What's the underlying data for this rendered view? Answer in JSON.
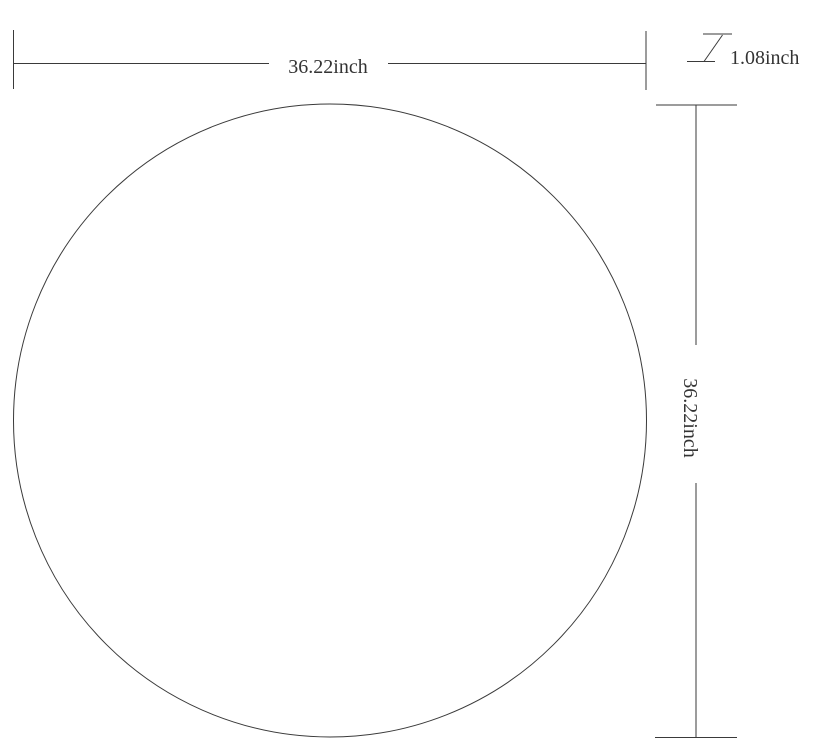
{
  "page": {
    "background_color": "#ffffff",
    "line_color": "#3a3a3a",
    "text_color": "#333333"
  },
  "drawing": {
    "kind": "product-dimension-diagram",
    "shape": "circle",
    "dimensions": {
      "width": {
        "value": 36.22,
        "unit": "inch",
        "label": "36.22inch"
      },
      "height": {
        "value": 36.22,
        "unit": "inch",
        "label": "36.22inch"
      },
      "thickness": {
        "value": 1.08,
        "unit": "inch",
        "label": "1.08inch"
      }
    }
  }
}
